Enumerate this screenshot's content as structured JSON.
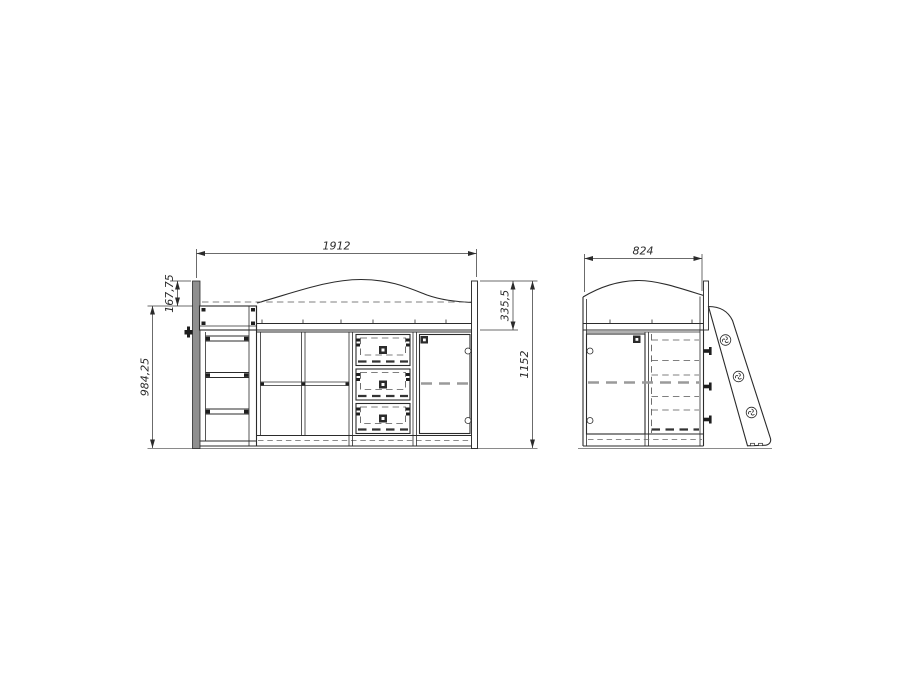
{
  "drawing": {
    "kind": "loft-bed technical drawing, front and side orthographic views"
  },
  "front_view": {
    "dims": {
      "overall_width": "1912",
      "top_section_height": "167,75",
      "base_height": "984,25",
      "rail_height": "335,5",
      "overall_height": "1152"
    }
  },
  "side_view": {
    "dims": {
      "overall_depth": "824"
    }
  },
  "colors": {
    "background": "#ffffff",
    "line": "#2b2b2b",
    "hidden_line": "#555555",
    "panel_grey": "#8f8f8f",
    "ground_line": "#8a8a8a"
  }
}
